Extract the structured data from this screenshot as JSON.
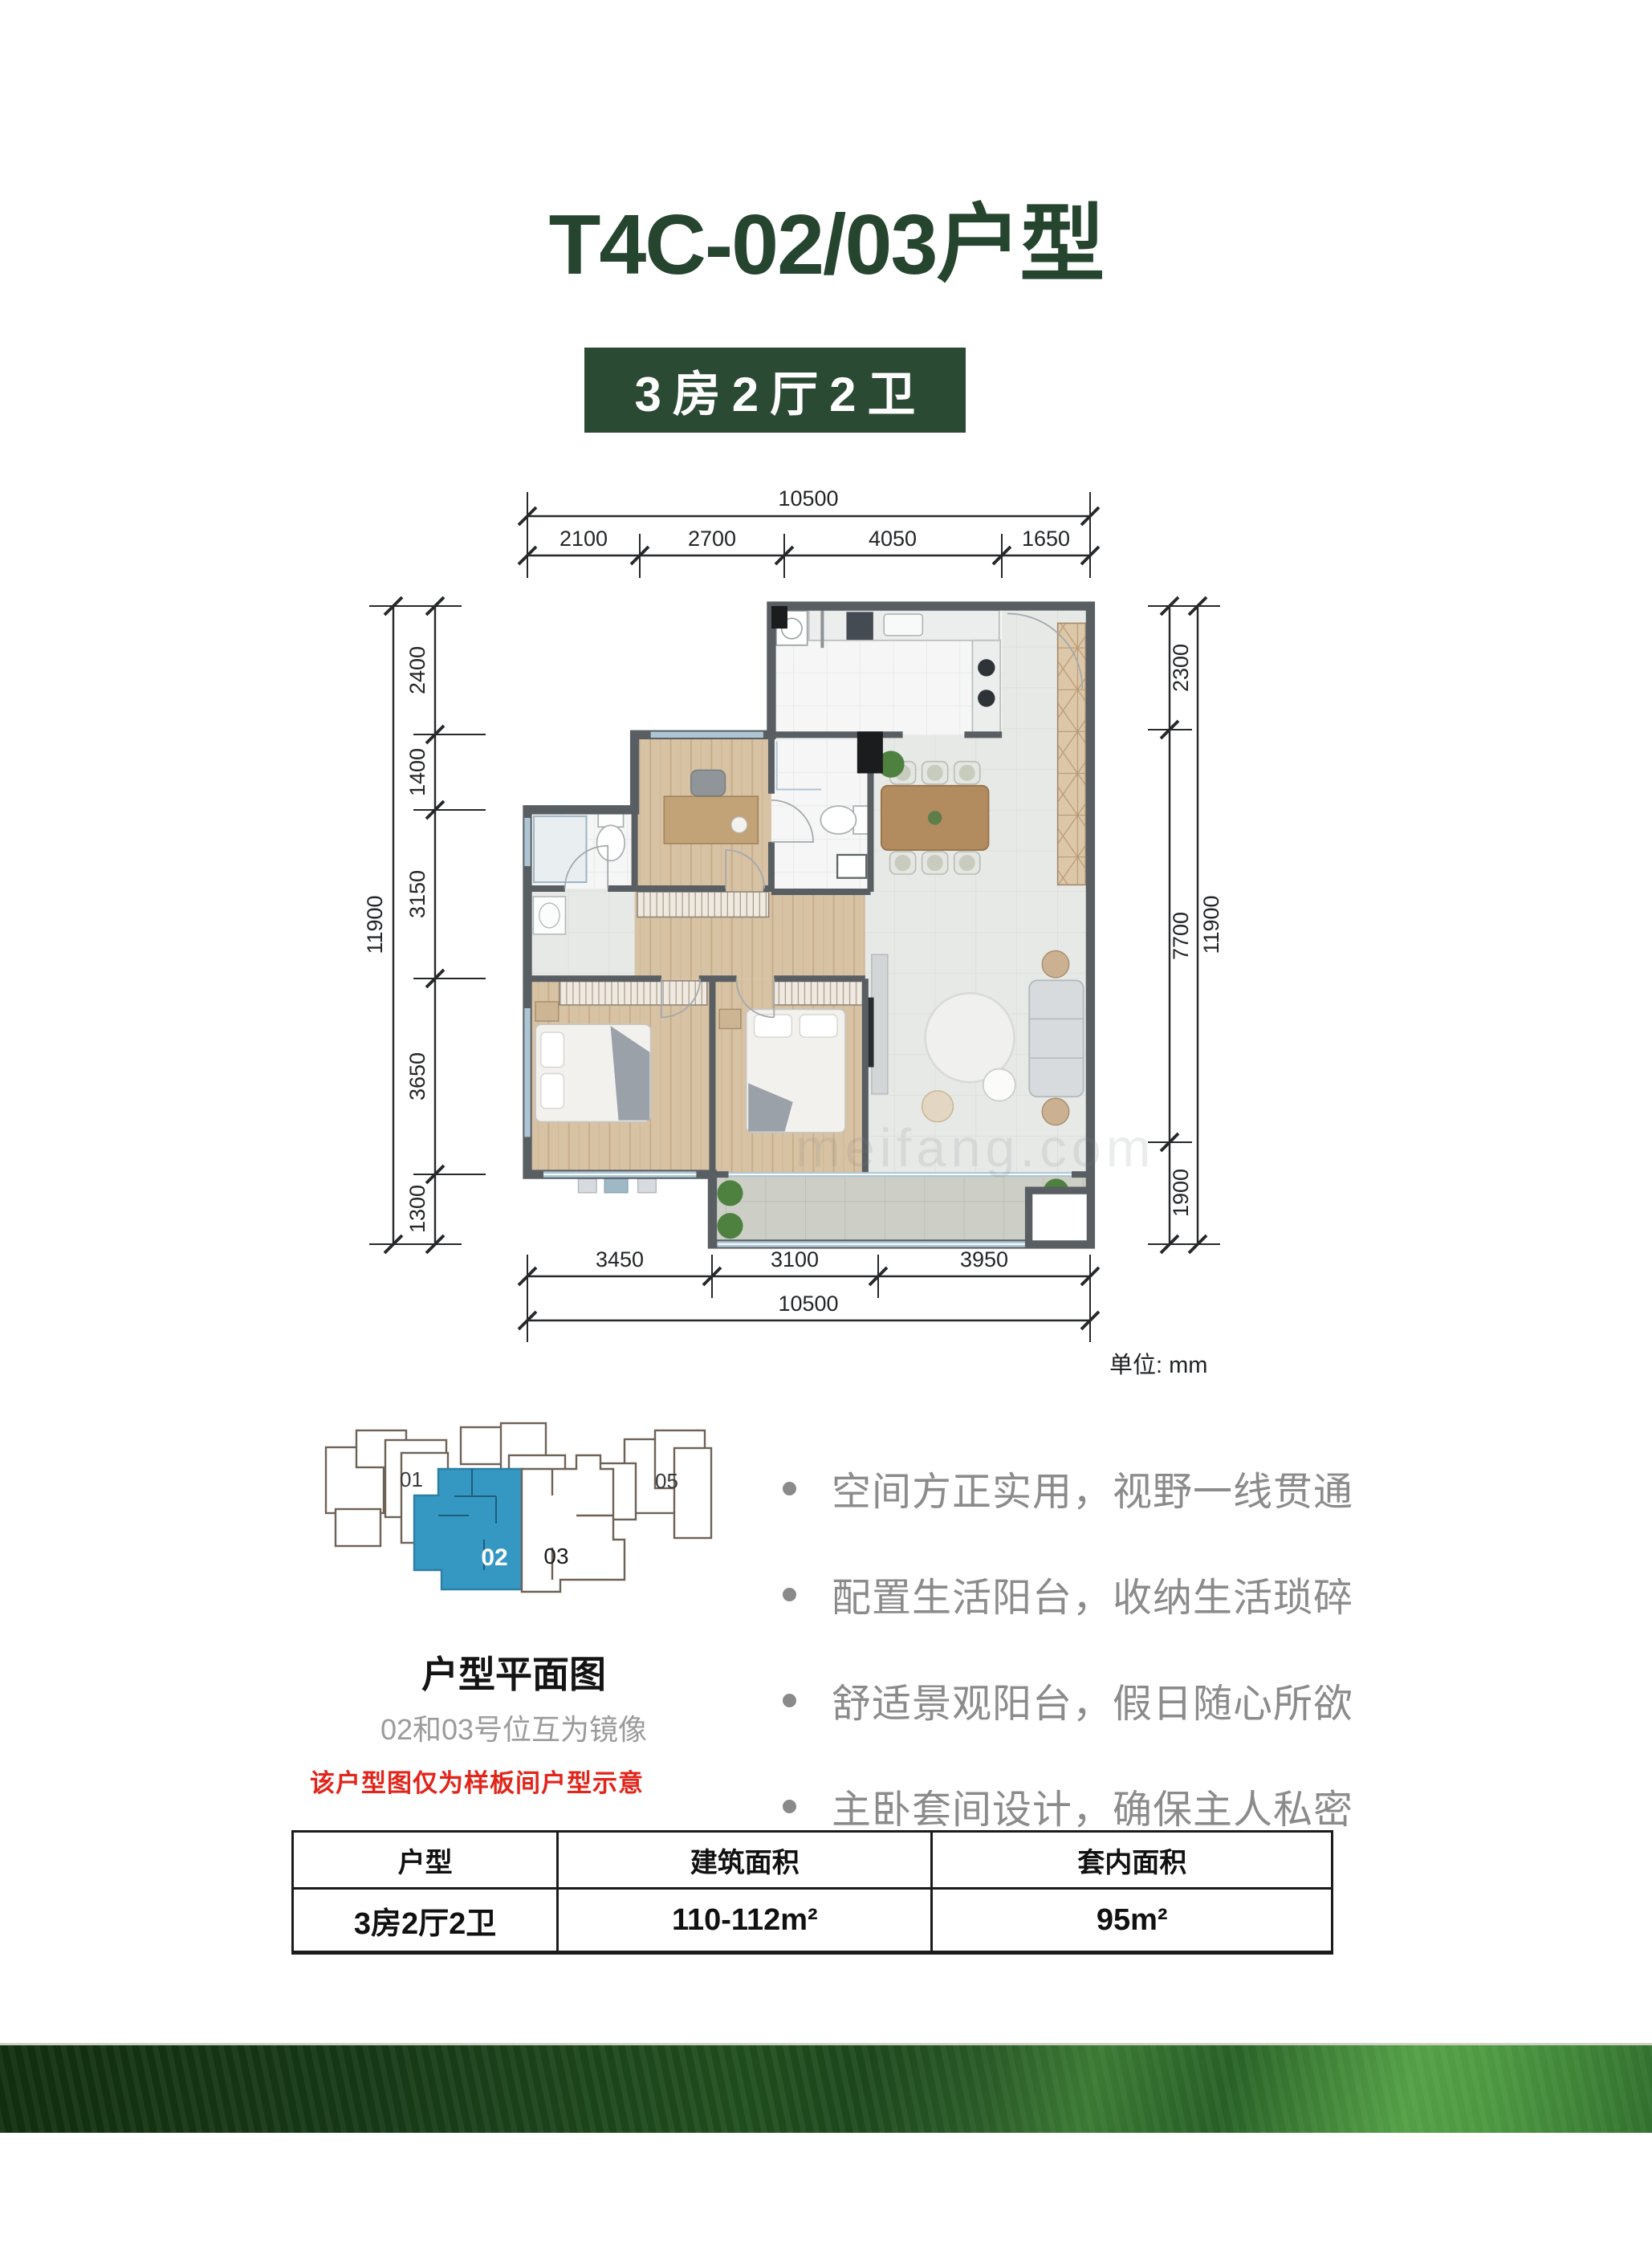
{
  "page": {
    "title": "T4C-02/03户型",
    "badge": "3房2厅2卫",
    "unit_label": "单位: mm"
  },
  "floor_plan": {
    "dimensions": {
      "top": {
        "total": "10500",
        "segments": [
          "2100",
          "2700",
          "4050",
          "1650"
        ]
      },
      "bottom": {
        "total": "10500",
        "segments": [
          "3450",
          "3100",
          "3950"
        ]
      },
      "left": {
        "total": "11900",
        "segments": [
          "2400",
          "1400",
          "3150",
          "3650",
          "1300"
        ]
      },
      "right": {
        "total": "11900",
        "segments": [
          "2300",
          "7700",
          "1900"
        ]
      }
    },
    "watermark": "meifang.com"
  },
  "key_plan": {
    "caption": "户型平面图",
    "subcaption": "02和03号位互为镜像",
    "highlighted_unit": "02",
    "units": [
      "01",
      "02",
      "03",
      "05"
    ],
    "highlight_color": "#3598c2"
  },
  "features": [
    "空间方正实用，视野一线贯通",
    "配置生活阳台，收纳生活琐碎",
    "舒适景观阳台，假日随心所欲",
    "主卧套间设计，确保主人私密"
  ],
  "disclaimer": "该户型图仅为样板间户型示意",
  "table": {
    "headers": [
      "户型",
      "建筑面积",
      "套内面积"
    ],
    "rows": [
      [
        "3房2厅2卫",
        "110-112m²",
        "95m²"
      ]
    ]
  },
  "colors": {
    "brand_green": "#26452f",
    "badge_green": "#2b4a33",
    "highlight_blue": "#3598c2",
    "disclaimer_red": "#e2251b"
  }
}
